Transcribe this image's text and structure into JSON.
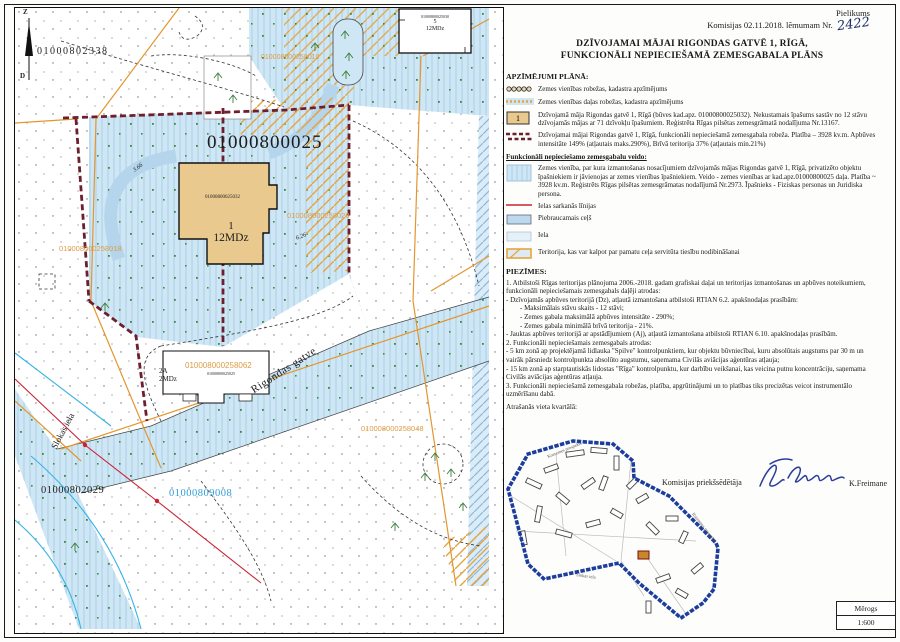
{
  "header": {
    "annex": "Pielikums",
    "decision": "Komisijas 02.11.2018. lēmumam Nr.",
    "decision_no": "2422",
    "title_line1": "DZĪVOJAMAI MĀJAI RIGONDAS GATVĒ 1, RĪGĀ,",
    "title_line2": "FUNKCIONĀLI NEPIECIEŠAMĀ ZEMESGABALA PLĀNS"
  },
  "legend": {
    "heading": "APZĪMĒJUMI PLĀNĀ:",
    "house_symbol": "1",
    "subheading": "Funkcionāli nepieciešamo zemesgabalu veido:",
    "items": [
      "Zemes vienības robežas, kadastra apzīmējums",
      "Zemes vienības daļas robežas, kadastra apzīmējums",
      "Dzīvojamā māja Rigondas gatvē 1, Rīgā (būves kad.apz. 01000800025032). Nekustamais īpašums sastāv no 12 stāvu dzīvojamās mājas ar 71 dzīvokļu īpašumiem. Reģistrēta Rīgas pilsētas zemesgrāmatā nodalījuma Nr.13167.",
      "Dzīvojamai mājai Rigondas gatvē 1, Rīgā, funkcionāli nepieciešamā zemesgabala robeža. Platība – 3928 kv.m. Apbūves intensitāte 149% (atļautais maks.290%), Brīvā teritorija 37% (atļautais min.21%)",
      "Zemes vienība, par kura izmantošanas nosacījumiem dzīvojamās mājas Rigondas gatvē 1, Rīgā, privatizēto objektu īpašniekiem ir jāvienojas ar zemes vienības īpašniekiem. Veido - zemes vienības ar kad.apz.01000800025 daļa. Platība ~ 3928 kv.m. Reģistrēts Rīgas pilsētas zemesgrāmatas nodalījumā Nr.2973. Īpašnieks - Fiziskas personas un Juridiska persona.",
      "Ielas sarkanās līnijas",
      "Piebraucamais ceļš",
      "Iela",
      "Teritorija, kas var kalpot par pamatu ceļa servitūta tiesību nodibināšanai"
    ]
  },
  "notes": {
    "heading": "PIEZĪMES:",
    "lines": [
      "1. Atbilstoši Rīgas teritorijas plānojuma 2006.-2018. gadam grafiskai daļai un teritorijas izmantošanas un apbūves noteikumiem, funkcionāli nepieciešamais zemesgabals daļēji atrodas:",
      "- Dzīvojamās apbūves teritorijā (Dz), atļautā izmantošana atbilstoši RTIAN 6.2. apakšnodaļas prasībām:",
      "- Maksimālais stāvu skaits - 12 stāvi;",
      "- Zemes gabala maksimālā apbūves intensitāte - 290%;",
      "- Zemes gabala minimālā brīvā teritorija - 21%.",
      "- Jauktas apbūves teritorijā ar apstādījumiem (Aj), atļautā izmantošana atbilstoši RTIAN 6.10. apakšnodaļas prasībām.",
      "2. Funkcionāli nepieciešamais zemesgabals atrodas:",
      "- 5 km zonā ap projektējamā lidlauka \"Spilve\" kontrolpunktiem, kur objektu būvniecībai, kuru absolūtais augstums par 30 m un vairāk pārsniedz kontrolpunkta absolūto augstumu, saņemama Civilās aviācijas aģentūras atļauja;",
      "- 15 km zonā ap starptautiskās lidostas \"Rīga\" kontrolpunktu, kur darbību veikšanai, kas veicina putnu koncentrāciju, saņemama Civilās aviācijas aģentūras atļauja.",
      "3. Funkcionāli nepieciešamā zemesgabala robežas, platība, apgrūtinājumi un to platības tiks precizētas veicot instrumentālo uzmērīšanu dabā."
    ],
    "location": "Atrašanās vieta kvartālā:"
  },
  "signature": {
    "role": "Komisijas priekšsēdētāja",
    "name": "K.Freimane"
  },
  "scale": {
    "label": "Mērogs",
    "value": "1:600"
  },
  "map": {
    "labels": {
      "parcel_main": "01000800025",
      "parcel_nw": "01000802338",
      "parcel_sw": "01000802029",
      "street_parcel": "01000809008",
      "part_010": "010008000258010",
      "part_018": "010008000258018",
      "part_028": "010008000258028",
      "part_048": "010008000258048",
      "part_062": "010008000258062",
      "bld1_cad": "01000800025032",
      "bld1_no": "1",
      "bld1_type": "12MDz",
      "bld5_cad": "01000800025030",
      "bld5_no": "5",
      "bld5_type": "12MDz",
      "bld2a_no": "2A",
      "bld2a_type": "2MDz",
      "bld2a_cad": "01000800025025",
      "street_rigondas": "Rigondas gatve",
      "street_slokas": "Slokas iela",
      "north_n": "Z",
      "north_s": "D",
      "dim_626": "6.26",
      "dim_366": "3.66"
    }
  },
  "inset": {
    "street1": "Kurzemes prospekts",
    "street2": "Slokas iela"
  },
  "colors": {
    "street_fill": "#cfe7f5",
    "drive_fill": "#b5d5ec",
    "building_tan": "#e9c98e",
    "boundary_red": "#6e1f2d",
    "red_line": "#cc2233",
    "orange": "#e3962f",
    "label_orange": "#dd9c45",
    "label_blue": "#2f9ed9",
    "ink_blue": "#2b3e9b"
  }
}
